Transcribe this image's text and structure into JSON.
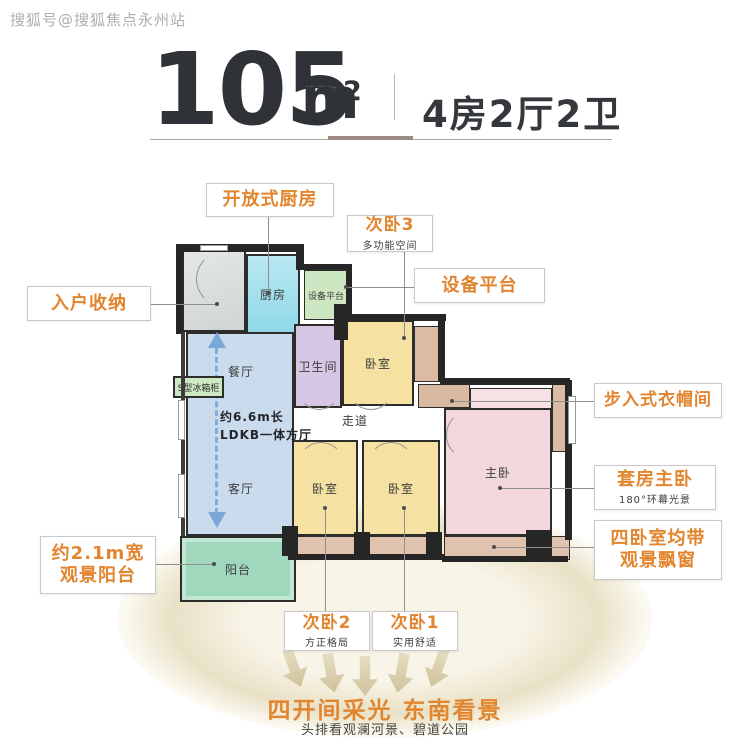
{
  "watermark": "搜狐号@搜狐焦点永州站",
  "header": {
    "area_value": "105",
    "area_prefix": "建面约",
    "area_unit": "m",
    "area_exponent": "2",
    "layout_text": "4房2厅2卫"
  },
  "plan": {
    "rooms": {
      "kitchen": "厨房",
      "equipment_platform": "设备平台",
      "dining": "餐厅",
      "living": "客厅",
      "bathroom1": "卫生间",
      "bathroom2": "卫生间",
      "bedroom_top": "卧室",
      "bedroom_left": "卧室",
      "bedroom_mid": "卧室",
      "master_bedroom": "主卧",
      "corridor": "走道",
      "balcony": "阳台"
    },
    "annotations": {
      "fridge_cabinet": "S型冰箱柜",
      "ldkb_line1": "约6.6m长",
      "ldkb_line2": "LDKB一体方厅"
    }
  },
  "callouts": {
    "open_kitchen": {
      "title": "开放式厨房"
    },
    "bedroom3": {
      "title": "次卧3",
      "subtitle": "多功能空间"
    },
    "equipment_platform": {
      "title": "设备平台"
    },
    "entry_storage": {
      "title": "入户收纳"
    },
    "walk_in_closet": {
      "title": "步入式衣帽间"
    },
    "master_suite": {
      "title": "套房主卧",
      "subtitle": "180°环幕光景"
    },
    "bay_windows": {
      "line1": "四卧室均带",
      "line2": "观景飘窗"
    },
    "view_balcony": {
      "line1": "约2.1m宽",
      "line2": "观景阳台"
    },
    "bedroom2": {
      "title": "次卧2",
      "subtitle": "方正格局"
    },
    "bedroom1": {
      "title": "次卧1",
      "subtitle": "实用舒适"
    }
  },
  "footer": {
    "headline": "四开间采光 东南看景",
    "subline": "头排看观澜河景、碧道公园"
  },
  "colors": {
    "accent_orange": "#E2852F",
    "wall_dark": "#2D2D2D",
    "kitchen_cyan": "#9EDFEC",
    "dining_blue": "#CBDBEE",
    "bedroom_yellow": "#F5E2A2",
    "master_pink": "#F2D7DC",
    "bathroom_purple": "#D7C7E5",
    "balcony_green": "#A0D8BE",
    "bay_tan": "#DBBBA4",
    "equipment_green": "#CDE7C2",
    "entrance_gray": "#D7DADA",
    "flow_arrow_blue": "#7BA7D8",
    "beam_beige": "#EAE3CB"
  }
}
